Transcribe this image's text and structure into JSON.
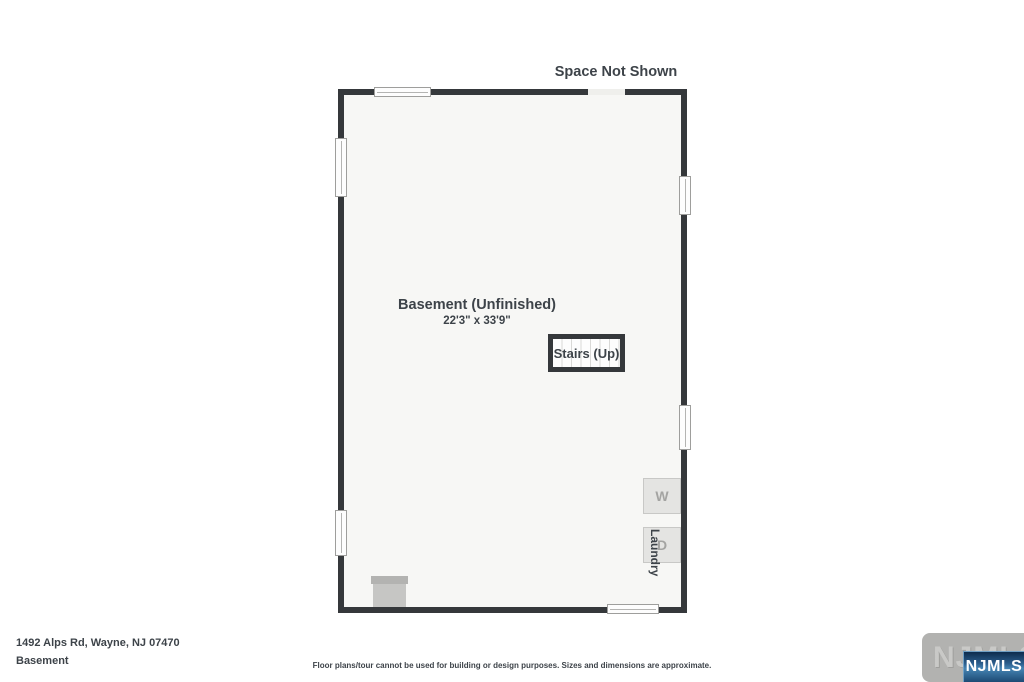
{
  "plan": {
    "space_not_shown": "Space Not Shown",
    "room": {
      "name": "Basement (Unfinished)",
      "dimensions": "22'3\" x 33'9\""
    },
    "stairs_label": "Stairs (Up)",
    "washer_letter": "W",
    "dryer_letter": "D",
    "laundry_label": "Laundry"
  },
  "footer": {
    "address": "1492 Alps Rd, Wayne, NJ 07470",
    "floor_name": "Basement",
    "disclaimer": "Floor plans/tour cannot be used for building or design purposes. Sizes and dimensions are approximate."
  },
  "logo": {
    "watermark_text": "NJMLS",
    "badge_text": "NJMLS"
  },
  "colors": {
    "wall": "#35383b",
    "floor": "#f7f7f5",
    "text": "#3d4349",
    "badge_blue": "#2b5d8c"
  }
}
